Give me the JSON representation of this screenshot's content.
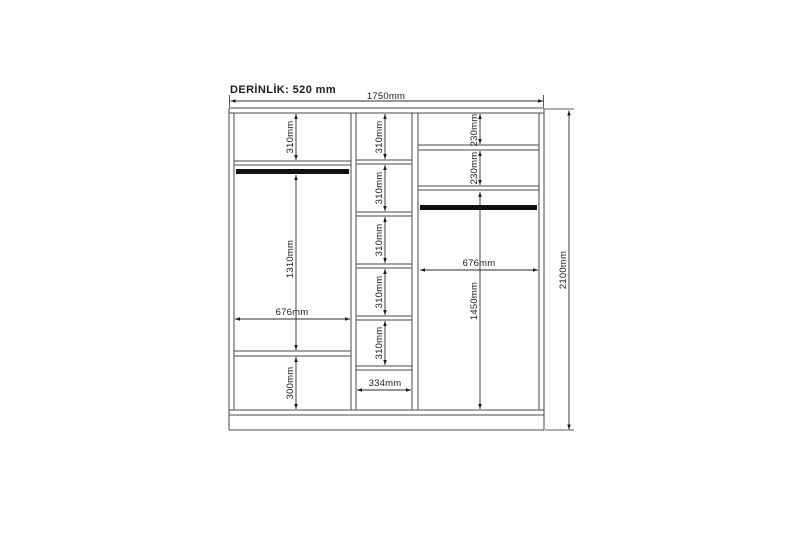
{
  "drawing": {
    "title": "DERİNLİK: 520 mm",
    "overall_width_label": "1750mm",
    "overall_height_label": "2100mm",
    "left_column": {
      "top_section_label": "310mm",
      "hanging_section_label": "1310mm",
      "width_label": "676mm",
      "bottom_section_label": "300mm"
    },
    "middle_column": {
      "section_labels": [
        "310mm",
        "310mm",
        "310mm",
        "310mm",
        "310mm"
      ],
      "width_label": "334mm"
    },
    "right_column": {
      "section_labels": [
        "230mm",
        "230mm"
      ],
      "width_label": "676mm",
      "hanging_section_label": "1450mm"
    }
  }
}
